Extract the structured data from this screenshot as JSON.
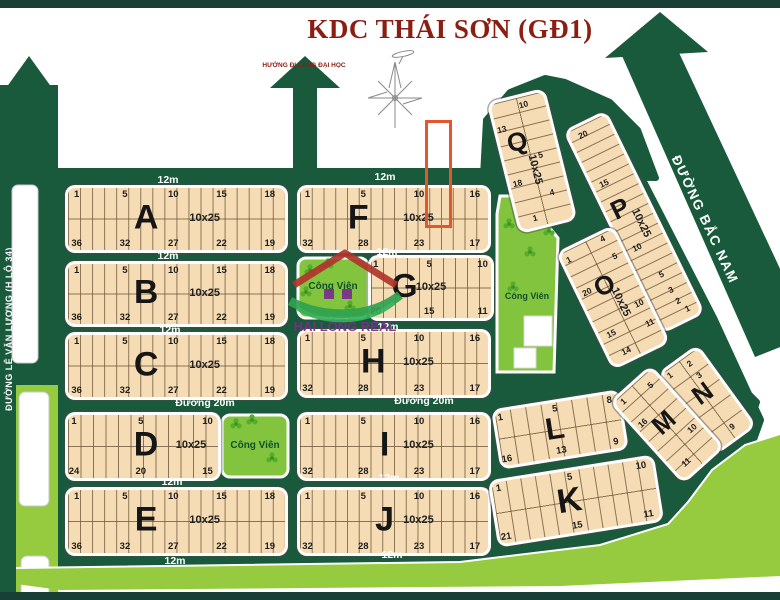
{
  "title": "KDC THÁI SƠN (GĐ1)",
  "labels": {
    "direction_note": "HƯỚNG ĐI LÀNG ĐẠI HỌC",
    "road_bac_nam": "ĐƯỜNG BẮC NAM",
    "road_le_van_luong": "ĐƯỜNG LÊ VĂN LƯƠNG (H LỘ 34)",
    "park": "Công Viên",
    "watermark": "HAI LONG REAL"
  },
  "colors": {
    "bar": "#173f35",
    "road": "#1a5a3c",
    "lime": "#96cb3f",
    "park_green": "#82c43e",
    "block_fill": "#f6dcb4",
    "lot_line": "rgba(100,80,50,0.75)",
    "title_red": "#8b1d12",
    "highlight": "#e4572e",
    "watermark_purple": "#7b2d8e",
    "watermark_green": "#2ea24f"
  },
  "highlight": {
    "x": 425,
    "y": 120,
    "w": 21,
    "h": 102
  },
  "road_labels": [
    {
      "text": "12m",
      "x": 168,
      "y": 181
    },
    {
      "text": "12m",
      "x": 385,
      "y": 178
    },
    {
      "text": "12m",
      "x": 168,
      "y": 257
    },
    {
      "text": "12m",
      "x": 387,
      "y": 253
    },
    {
      "text": "12m",
      "x": 170,
      "y": 331
    },
    {
      "text": "12m",
      "x": 388,
      "y": 328
    },
    {
      "text": "Đường 20m",
      "x": 205,
      "y": 404
    },
    {
      "text": "Đường 20m",
      "x": 424,
      "y": 402
    },
    {
      "text": "12m",
      "x": 172,
      "y": 483
    },
    {
      "text": "12m",
      "x": 389,
      "y": 479
    },
    {
      "text": "12m",
      "x": 175,
      "y": 562
    },
    {
      "text": "12m",
      "x": 392,
      "y": 556
    }
  ],
  "parks": [
    {
      "label": "Công Viên",
      "clovers": [
        [
          310,
          270
        ],
        [
          328,
          264
        ],
        [
          306,
          292
        ],
        [
          350,
          306
        ]
      ]
    },
    {
      "label": "Công Viên",
      "clovers": [
        [
          236,
          424
        ],
        [
          252,
          420
        ],
        [
          272,
          458
        ]
      ]
    },
    {
      "label": "Công Viên",
      "clovers": [
        [
          521,
          204
        ],
        [
          543,
          200
        ],
        [
          509,
          224
        ],
        [
          530,
          252
        ],
        [
          549,
          231
        ],
        [
          513,
          287
        ]
      ]
    }
  ],
  "blocks": [
    {
      "id": "A",
      "letter": "A",
      "size": "10x25",
      "x": 68,
      "y": 188,
      "w": 217,
      "h": 62,
      "cols": 18,
      "top": [
        "1",
        "5",
        "10",
        "15",
        "18"
      ],
      "bottom": [
        "36",
        "32",
        "27",
        "22",
        "19"
      ]
    },
    {
      "id": "B",
      "letter": "B",
      "size": "10x25",
      "x": 68,
      "y": 264,
      "w": 217,
      "h": 60,
      "cols": 18,
      "top": [
        "1",
        "5",
        "10",
        "15",
        "18"
      ],
      "bottom": [
        "36",
        "32",
        "27",
        "22",
        "19"
      ]
    },
    {
      "id": "C",
      "letter": "C",
      "size": "10x25",
      "x": 68,
      "y": 335,
      "w": 217,
      "h": 62,
      "cols": 18,
      "top": [
        "1",
        "5",
        "10",
        "15",
        "18"
      ],
      "bottom": [
        "36",
        "32",
        "27",
        "22",
        "19"
      ]
    },
    {
      "id": "D",
      "letter": "D",
      "size": "10x25",
      "x": 68,
      "y": 415,
      "w": 150,
      "h": 63,
      "cols": 12,
      "top": [
        "1",
        "5",
        "10"
      ],
      "bottom": [
        "24",
        "20",
        "15"
      ],
      "lx": 52,
      "sx": 82
    },
    {
      "id": "E",
      "letter": "E",
      "size": "10x25",
      "x": 68,
      "y": 490,
      "w": 217,
      "h": 63,
      "cols": 18,
      "top": [
        "1",
        "5",
        "10",
        "15",
        "18"
      ],
      "bottom": [
        "36",
        "32",
        "27",
        "22",
        "19"
      ]
    },
    {
      "id": "F",
      "letter": "F",
      "size": "10x25",
      "x": 300,
      "y": 188,
      "w": 188,
      "h": 62,
      "cols": 16,
      "top": [
        "1",
        "5",
        "10",
        "16"
      ],
      "bottom": [
        "32",
        "28",
        "23",
        "17"
      ],
      "lx": 31
    },
    {
      "id": "G",
      "letter": "G",
      "size": "10x25",
      "x": 371,
      "y": 258,
      "w": 120,
      "h": 60,
      "cols": 10,
      "top": [
        "1",
        "5",
        "10"
      ],
      "bottom": [
        "20",
        "15",
        "11"
      ],
      "lx": 28,
      "sx": 50
    },
    {
      "id": "H",
      "letter": "H",
      "size": "10x25",
      "x": 300,
      "y": 332,
      "w": 188,
      "h": 63,
      "cols": 16,
      "top": [
        "1",
        "5",
        "10",
        "16"
      ],
      "bottom": [
        "32",
        "28",
        "23",
        "17"
      ],
      "lx": 39
    },
    {
      "id": "I",
      "letter": "I",
      "size": "10x25",
      "x": 300,
      "y": 415,
      "w": 188,
      "h": 63,
      "cols": 16,
      "top": [
        "1",
        "5",
        "10",
        "16"
      ],
      "bottom": [
        "32",
        "28",
        "23",
        "17"
      ],
      "lx": 45
    },
    {
      "id": "J",
      "letter": "J",
      "size": "10x25",
      "x": 300,
      "y": 490,
      "w": 188,
      "h": 63,
      "cols": 16,
      "top": [
        "1",
        "5",
        "10",
        "16"
      ],
      "bottom": [
        "32",
        "28",
        "23",
        "17"
      ],
      "lx": 45
    },
    {
      "id": "L",
      "letter": "L",
      "x": 498,
      "y": 402,
      "w": 124,
      "h": 55,
      "rot": -9,
      "cols": 8,
      "top": [
        "1",
        "5",
        "8"
      ],
      "bottom": [
        "16",
        "13",
        "9"
      ],
      "lx": 46
    },
    {
      "id": "K",
      "letter": "K",
      "x": 495,
      "y": 470,
      "w": 162,
      "h": 62,
      "rot": -9,
      "cols": 11,
      "top": [
        "1",
        "5",
        "10"
      ],
      "bottom": [
        "21",
        "15",
        "11"
      ],
      "lx": 46
    },
    {
      "id": "Q",
      "letter": "Q",
      "size": "10x25",
      "x": 505,
      "y": 96,
      "w": 54,
      "h": 130,
      "rot": -14,
      "vertical": true,
      "rows": 9,
      "twocol": true,
      "letter_pos": [
        32,
        33
      ],
      "size_pos": [
        52,
        57
      ],
      "nums": [
        {
          "v": "13",
          "x": 10,
          "y": 21
        },
        {
          "v": "10",
          "x": 60,
          "y": 6
        },
        {
          "v": "5",
          "x": 68,
          "y": 47
        },
        {
          "v": "18",
          "x": 14,
          "y": 64
        },
        {
          "v": "4",
          "x": 72,
          "y": 77
        },
        {
          "v": "1",
          "x": 30,
          "y": 93
        }
      ]
    },
    {
      "id": "P",
      "letter": "P",
      "size": "10x25",
      "x": 613,
      "y": 112,
      "w": 42,
      "h": 220,
      "rot": -26,
      "vertical": true,
      "rows": 20,
      "twocol": false,
      "letter_pos": [
        34,
        42
      ],
      "size_pos": [
        64,
        52
      ],
      "nums": [
        {
          "v": "20",
          "x": 32,
          "y": 4
        },
        {
          "v": "15",
          "x": 26,
          "y": 28
        },
        {
          "v": "10",
          "x": 30,
          "y": 61
        },
        {
          "v": "5",
          "x": 54,
          "y": 77
        },
        {
          "v": "3",
          "x": 58,
          "y": 85
        },
        {
          "v": "2",
          "x": 62,
          "y": 91
        },
        {
          "v": "1",
          "x": 74,
          "y": 96
        }
      ]
    },
    {
      "id": "O",
      "letter": "O",
      "size": "10x25",
      "x": 584,
      "y": 235,
      "w": 58,
      "h": 125,
      "rot": -26,
      "vertical": true,
      "rows": 10,
      "twocol": true,
      "letter_pos": [
        46,
        38
      ],
      "size_pos": [
        58,
        56
      ],
      "nums": [
        {
          "v": "1",
          "x": 10,
          "y": 7
        },
        {
          "v": "4",
          "x": 78,
          "y": 4
        },
        {
          "v": "5",
          "x": 84,
          "y": 21
        },
        {
          "v": "20",
          "x": 14,
          "y": 37
        },
        {
          "v": "10",
          "x": 86,
          "y": 63
        },
        {
          "v": "15",
          "x": 20,
          "y": 75
        },
        {
          "v": "11",
          "x": 88,
          "y": 81
        },
        {
          "v": "14",
          "x": 30,
          "y": 93
        }
      ]
    },
    {
      "id": "N",
      "letter": "N",
      "x": 685,
      "y": 352,
      "w": 44,
      "h": 95,
      "rot": -36,
      "vertical": true,
      "rows": 5,
      "twocol": true,
      "letter_pos": [
        50,
        42
      ],
      "nums": [
        {
          "v": "1",
          "x": 14,
          "y": 6
        },
        {
          "v": "2",
          "x": 66,
          "y": 8
        },
        {
          "v": "3",
          "x": 68,
          "y": 24
        },
        {
          "v": "9",
          "x": 60,
          "y": 88
        }
      ]
    },
    {
      "id": "M",
      "letter": "M",
      "x": 642,
      "y": 372,
      "w": 50,
      "h": 105,
      "rot": -42,
      "vertical": true,
      "rows": 8,
      "twocol": true,
      "letter_pos": [
        48,
        47
      ],
      "nums": [
        {
          "v": "1",
          "x": 16,
          "y": 6
        },
        {
          "v": "5",
          "x": 78,
          "y": 11
        },
        {
          "v": "16",
          "x": 16,
          "y": 33
        },
        {
          "v": "10",
          "x": 82,
          "y": 69
        },
        {
          "v": "11",
          "x": 28,
          "y": 89
        }
      ]
    }
  ]
}
